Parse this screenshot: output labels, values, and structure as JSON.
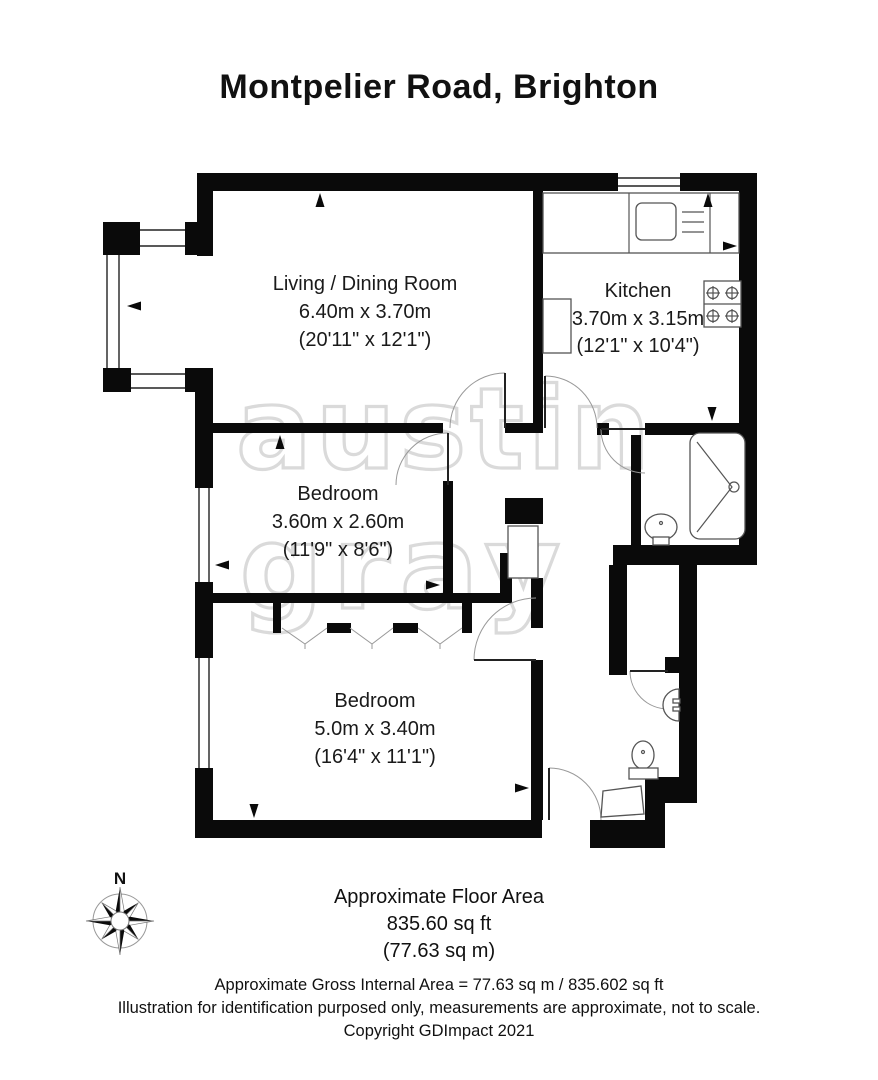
{
  "title": "Montpelier Road, Brighton",
  "watermark": {
    "line1": "austin",
    "line2": "gray"
  },
  "compass": {
    "label": "N"
  },
  "rooms": [
    {
      "name": "Living / Dining Room",
      "metric": "6.40m x 3.70m",
      "imperial": "(20'11\" x 12'1\")"
    },
    {
      "name": "Kitchen",
      "metric": "3.70m x 3.15m",
      "imperial": "(12'1\" x 10'4\")"
    },
    {
      "name": "Bedroom",
      "metric": "3.60m x 2.60m",
      "imperial": "(11'9\" x 8'6\")"
    },
    {
      "name": "Bedroom",
      "metric": "5.0m x 3.40m",
      "imperial": "(16'4\" x 11'1\")"
    }
  ],
  "floor_area": {
    "line1": "Approximate Floor Area",
    "line2": "835.60 sq ft",
    "line3": "(77.63 sq m)"
  },
  "footer": {
    "line1": "Approximate Gross Internal Area = 77.63 sq m / 835.602 sq ft",
    "line2": "Illustration for identification purposed only, measurements are approximate, not to scale.",
    "line3": "Copyright GDImpact 2021"
  },
  "colors": {
    "wall": "#0a0a0a",
    "background": "#ffffff",
    "watermark": "#dadada",
    "fixture_outline": "#555555"
  }
}
